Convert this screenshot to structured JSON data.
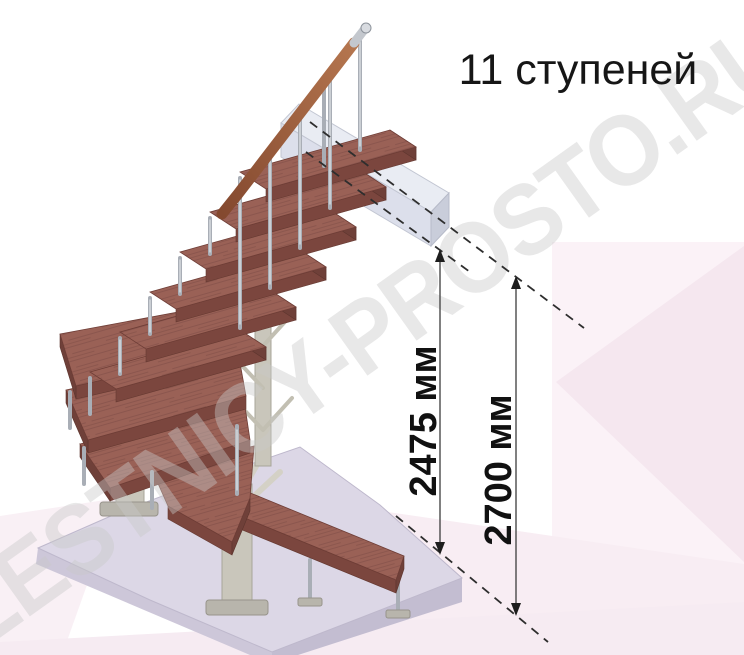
{
  "title": "11 ступеней",
  "stairs": {
    "steps_count": 11
  },
  "dimensions": {
    "inner": {
      "label": "2475 мм"
    },
    "outer": {
      "label": "2700 мм"
    }
  },
  "watermark": "LESTNICY-PROSTO.RU",
  "colors": {
    "wood_base": "#9a6156",
    "wood_grain": "#82504a",
    "wood_edge": "#7b463e",
    "rail_light": "#b5764f",
    "rail_dark": "#84492f",
    "metal": "#a9aeb6",
    "column": "#c9c6bb",
    "floor_slab_top": "#dcd7e6",
    "floor_slab_left": "#cdc7d9",
    "floor_slab_right": "#c3bdd1",
    "landing_top": "#e9ecf3",
    "landing_front": "#dcdfeb",
    "landing_end": "#c9cdda",
    "background_pink": "#fbf2f7",
    "background_pink_deep": "#f5e7ef",
    "watermark": "#c9c9c9",
    "annotation": "#1a1a1a"
  }
}
